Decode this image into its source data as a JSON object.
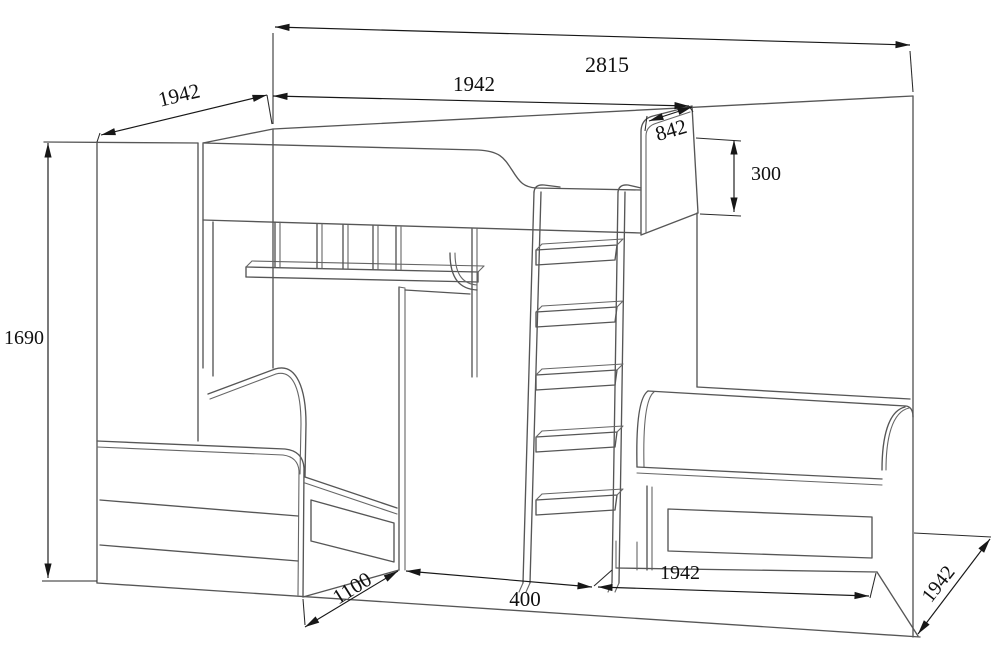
{
  "dimensions": {
    "total_width": "2815",
    "top_bed_length": "1942",
    "left_side_depth": "1942",
    "headboard_width": "842",
    "headboard_height": "300",
    "total_height": "1690",
    "front_bed_width": "1100",
    "ladder_gap": "400",
    "lower_bed_length": "1942",
    "right_side_depth": "1942"
  },
  "colors": {
    "background": "#ffffff",
    "structure_line": "#565656",
    "dimension_line": "#171717",
    "label_text": "#101010"
  }
}
